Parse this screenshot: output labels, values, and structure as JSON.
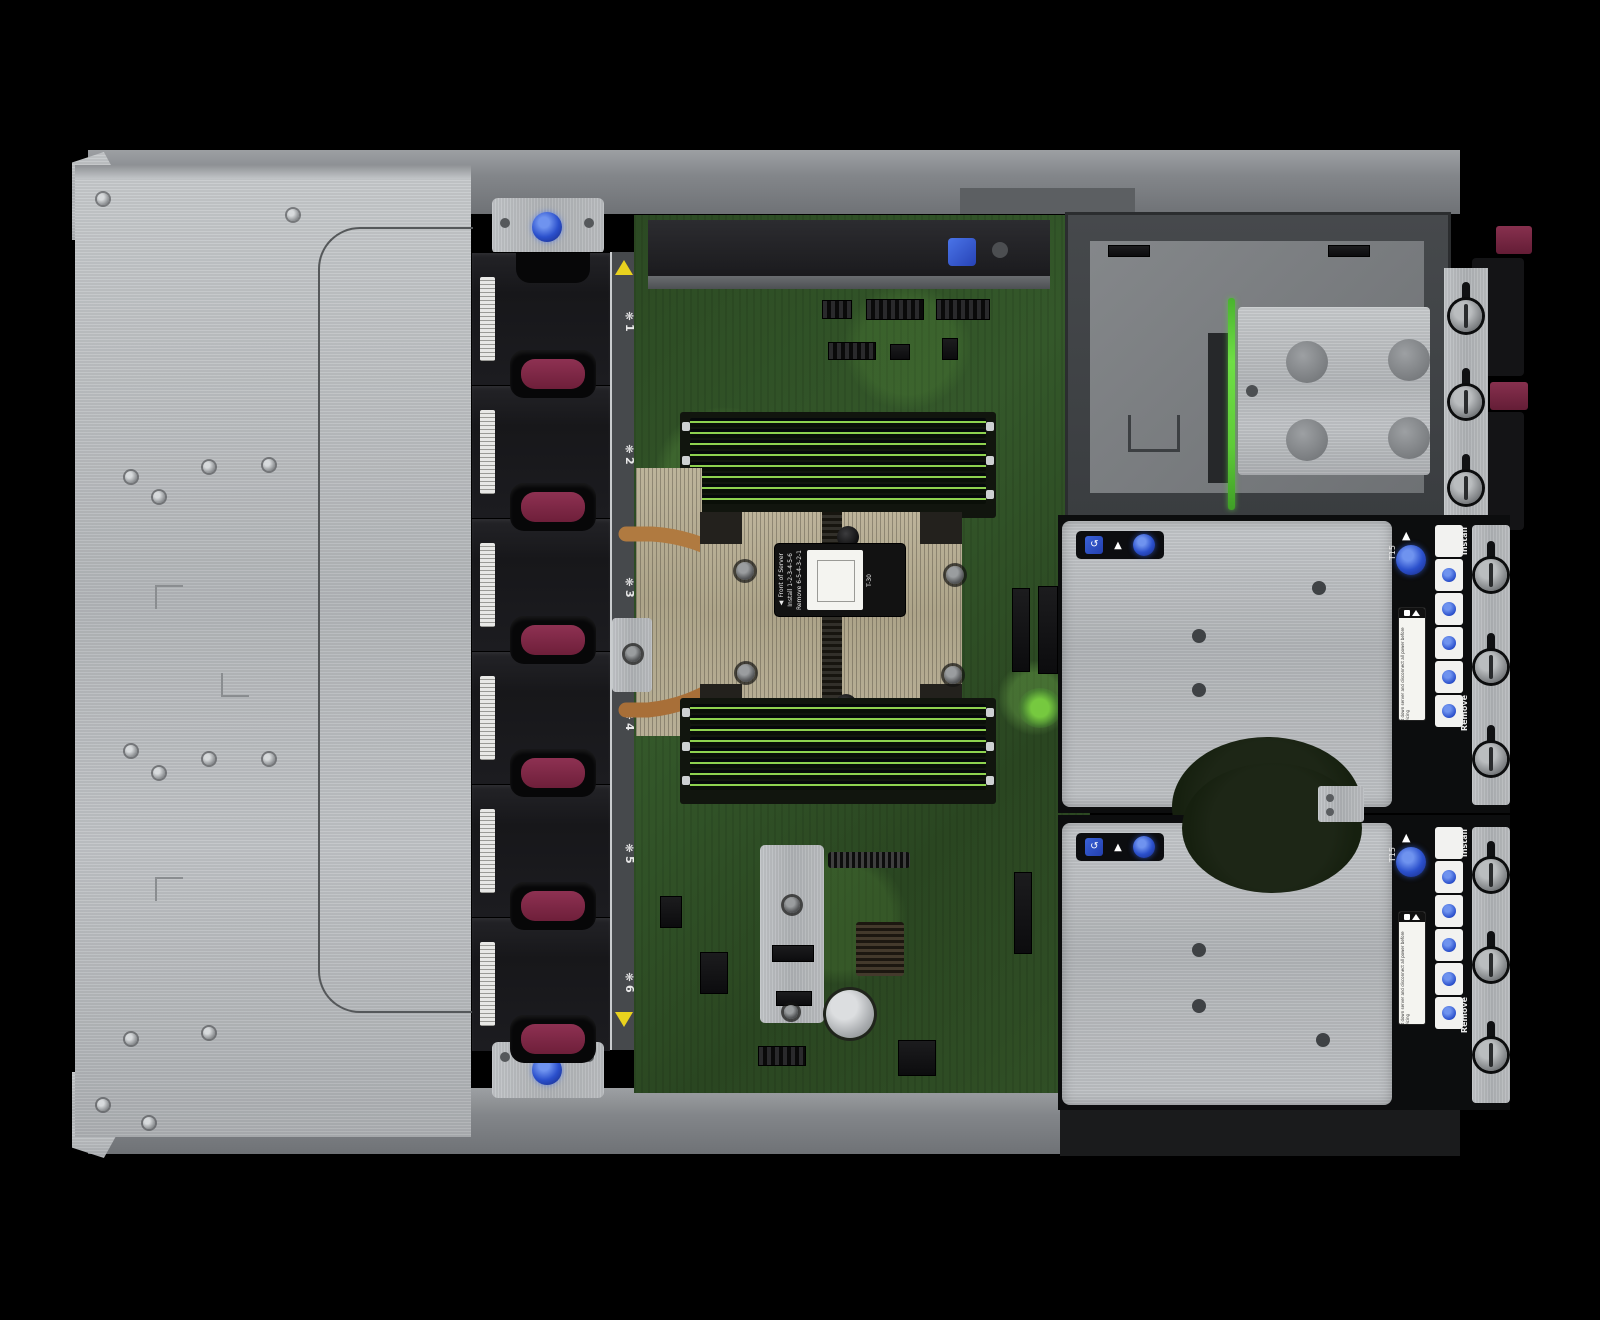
{
  "scene": {
    "description": "Top-down interior view of a rack server with access panel removed: drive-bay cover plate (left), six hot-plug fan modules, system board with DIMM banks and CPU heatsink, power-supply / media cage (top right) and two PCIe riser cages (right).",
    "background": "#000000"
  },
  "palette": {
    "chassis_silver": "#c2c5c8",
    "fan_black": "#1b1b1e",
    "handle_maroon": "#7d2742",
    "board_green": "#2f4f26",
    "dimm_latch_green": "#8ed24f",
    "heatsink_beige": "#b3aa90",
    "copper": "#b0743c",
    "touchpoint_blue": "#2b50cc",
    "warning_yellow": "#e9d21e"
  },
  "fan_bank": {
    "icon": "❋",
    "bays": [
      {
        "label": "1"
      },
      {
        "label": "2"
      },
      {
        "label": "3"
      },
      {
        "label": "4"
      },
      {
        "label": "5"
      },
      {
        "label": "6"
      }
    ]
  },
  "heatsink": {
    "label": {
      "front_arrow": "▲",
      "front": "Front of Server",
      "install": "Install",
      "install_seq": "1-2-3-4-5-6",
      "remove": "Remove",
      "remove_seq": "6-5-4-3-2-1",
      "torx": "T-30"
    }
  },
  "risers": [
    {
      "torx": "T15",
      "arrow": "▲",
      "install": "Install",
      "remove": "Remove",
      "caution": "Shut down server and disconnect all power before servicing"
    },
    {
      "torx": "T15",
      "arrow": "▲",
      "install": "Install",
      "remove": "Remove",
      "caution": "Shut down server and disconnect all power before servicing"
    }
  ]
}
